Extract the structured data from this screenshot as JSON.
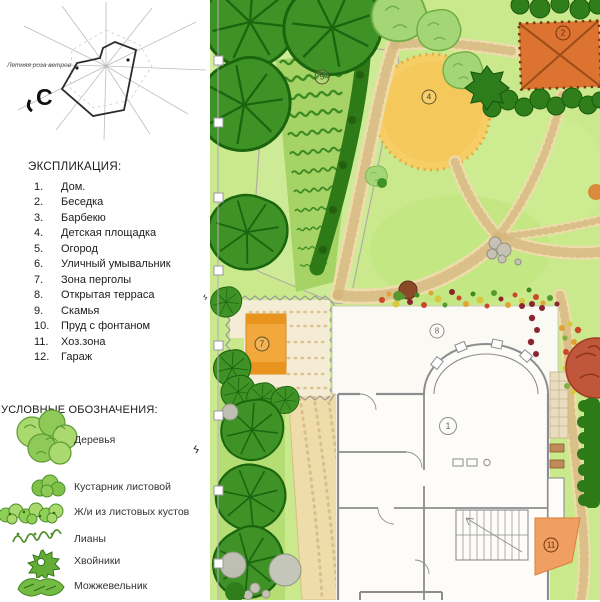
{
  "wind_rose": {
    "label": "Летняя роза ветров",
    "north": "С"
  },
  "explication": {
    "title": "ЭКСПЛИКАЦИЯ:",
    "items": [
      {
        "num": "1.",
        "label": "Дом."
      },
      {
        "num": "2.",
        "label": "Беседка"
      },
      {
        "num": "3.",
        "label": "Барбекю"
      },
      {
        "num": "4.",
        "label": "Детская площадка"
      },
      {
        "num": "5.",
        "label": "Огород"
      },
      {
        "num": "6.",
        "label": "Уличный умывальник"
      },
      {
        "num": "7.",
        "label": "Зона перголы"
      },
      {
        "num": "8.",
        "label": "Открытая терраса"
      },
      {
        "num": "9.",
        "label": "Скамья"
      },
      {
        "num": "10.",
        "label": "Пруд с фонтаном"
      },
      {
        "num": "11.",
        "label": "Хоз.зона"
      },
      {
        "num": "12.",
        "label": "Гараж"
      }
    ]
  },
  "symbols": {
    "title": "УСЛОВНЫЕ ОБОЗНАЧЕНИЯ:",
    "items": [
      {
        "icon": "tree-icon",
        "label": "Деревья"
      },
      {
        "icon": "leafy-shrub-icon",
        "label": "Кустарник листовой"
      },
      {
        "icon": "leafy-hedge-icon",
        "label": "Ж/и из листовых кустов"
      },
      {
        "icon": "liana-icon",
        "label": "Лианы"
      },
      {
        "icon": "conifer-icon",
        "label": "Хвойники"
      },
      {
        "icon": "juniper-icon",
        "label": "Можжевельник"
      }
    ]
  },
  "plan": {
    "markers": [
      {
        "num": "5",
        "area": "Огород"
      },
      {
        "num": "4",
        "area": "Детская площадка"
      },
      {
        "num": "2",
        "area": "Беседка"
      },
      {
        "num": "7",
        "area": "Зона перголы"
      },
      {
        "num": "8",
        "area": "Открытая терраса"
      },
      {
        "num": "1",
        "area": "Дом"
      },
      {
        "num": "11",
        "area": "Хоз.зона"
      }
    ]
  },
  "colors": {
    "lawn": "#c9e98c",
    "path": "#eedcab",
    "tree_dark": "#3f9326",
    "gazebo_orange": "#dd7330",
    "playground_yellow": "#f7cd66",
    "pergola_table": "#f2a83c",
    "utility_zone": "#f09e62",
    "red_tree": "#c0563a"
  }
}
